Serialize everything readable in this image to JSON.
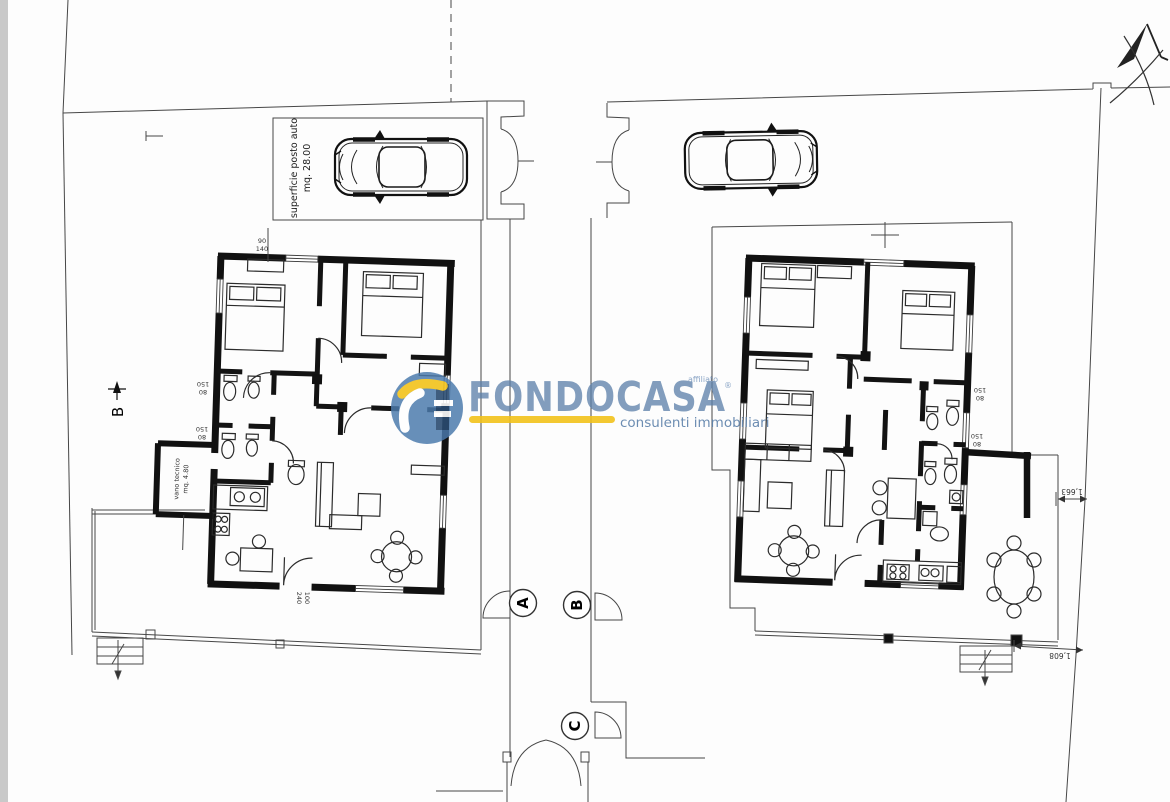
{
  "watermark": {
    "brand": "FONDOCASA",
    "affiliate_label": "affiliato",
    "registered_mark": "®",
    "tagline": "consulenti immobiliari",
    "colors": {
      "circle_blue": "#4a7aac",
      "wordmark_blue": "#5d81aa",
      "accent_yellow": "#f3c31c"
    }
  },
  "left_plan": {
    "parking_label": {
      "line1": "superficie posto auto",
      "line2": "mq. 28.00"
    },
    "tech_room_label": {
      "line1": "vano tecnico",
      "line2": "mq. 4.80"
    },
    "section_marker": "B"
  },
  "right_plan": {
    "boundary_dims": {
      "upper": "1,663",
      "lower": "1,608"
    }
  },
  "gate_markers": {
    "a": "A",
    "b": "B",
    "c": "C"
  },
  "window_dims": {
    "w80": "80",
    "h150": "150",
    "w90": "90",
    "h140": "140",
    "w100": "100",
    "h240": "240"
  }
}
